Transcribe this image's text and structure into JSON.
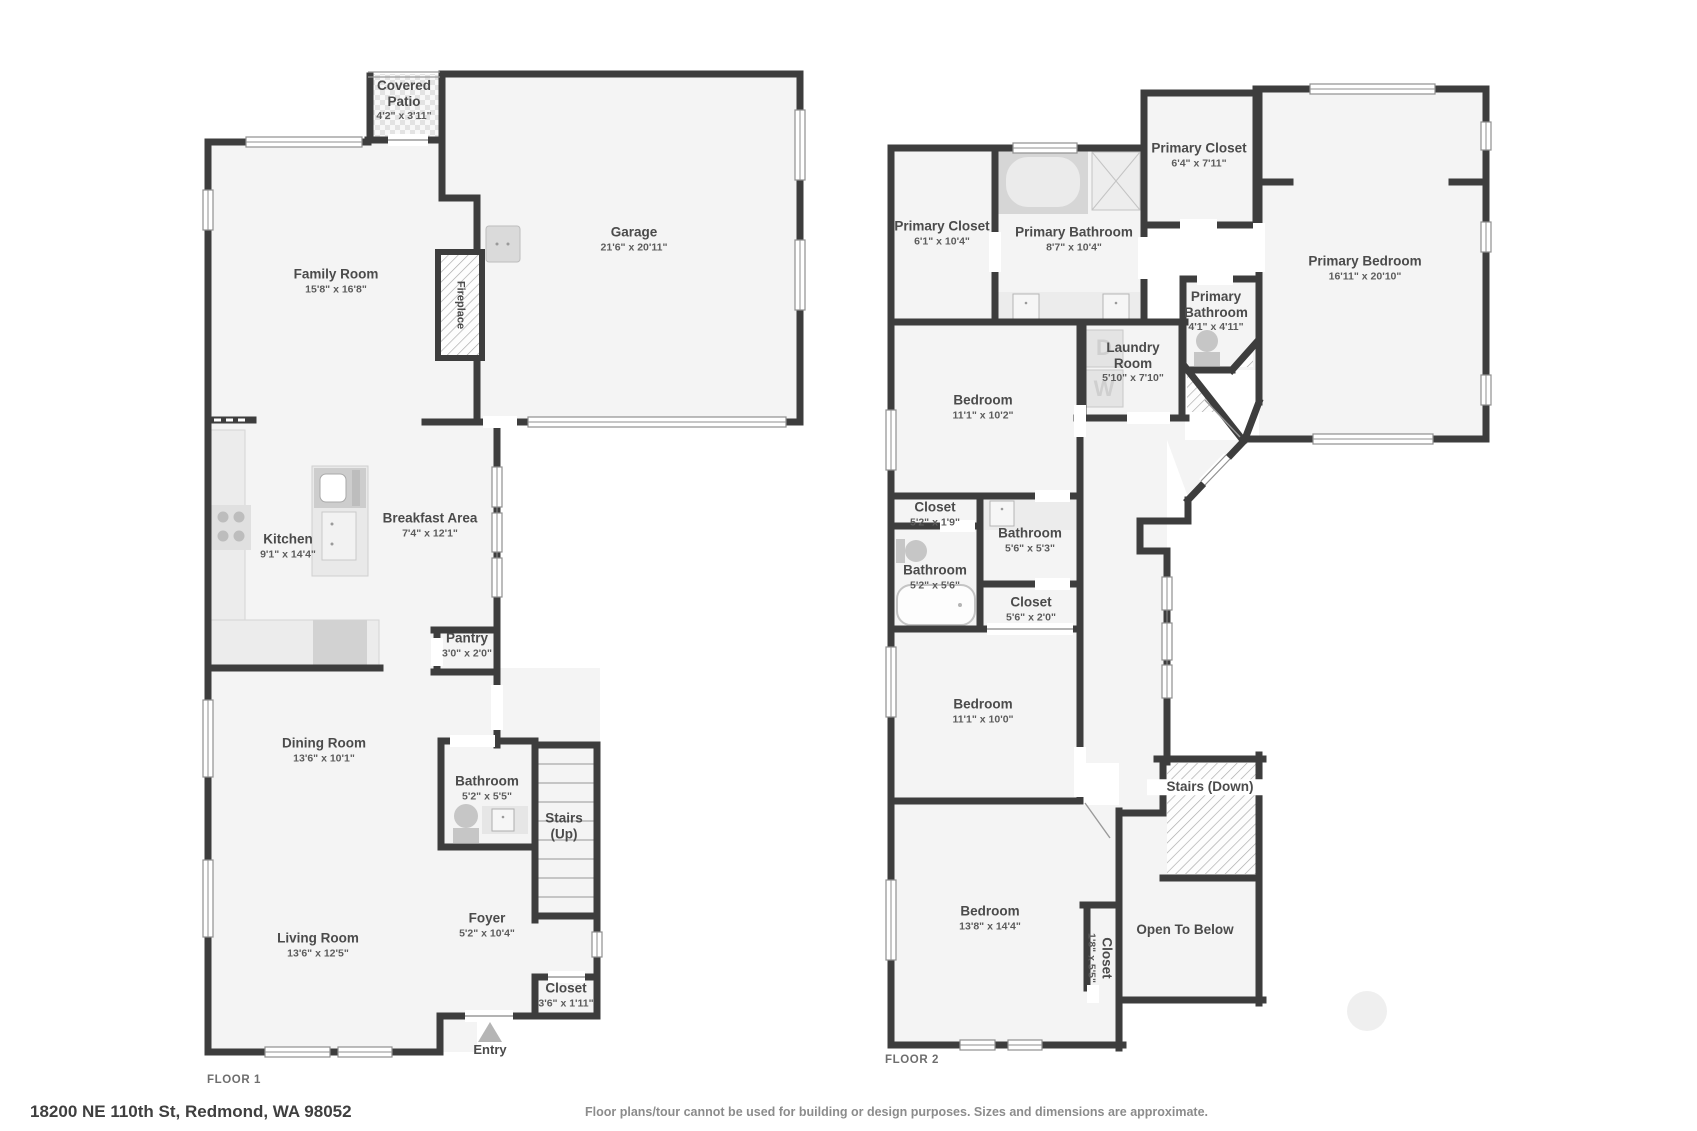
{
  "page": {
    "address": "18200 NE 110th St, Redmond, WA 98052",
    "disclaimer": "Floor plans/tour cannot be used for building or design purposes. Sizes and dimensions are approximate."
  },
  "entry": {
    "label": "Entry"
  },
  "colors": {
    "wall": "#3d3d3d",
    "room_fill": "#f4f4f4",
    "thin_line": "#8f8f8f",
    "fixture": "#cfcfcf",
    "accent_text": "#4b4b4b"
  },
  "floors": [
    {
      "caption": "FLOOR 1",
      "caption_x": 207,
      "caption_y": 1074,
      "rooms": [
        {
          "id": "covered-patio",
          "name": "Covered Patio",
          "dims": "4'2\" x 3'11\"",
          "x": 404,
          "y": 100,
          "w": 74
        },
        {
          "id": "family-room",
          "name": "Family Room",
          "dims": "15'8\" x 16'8\"",
          "x": 336,
          "y": 281,
          "w": 120
        },
        {
          "id": "garage",
          "name": "Garage",
          "dims": "21'6\" x 20'11\"",
          "x": 634,
          "y": 239,
          "w": 130
        },
        {
          "id": "fireplace",
          "name": "Fireplace",
          "dims": "",
          "x": 460,
          "y": 305,
          "w": 90,
          "rot": 90,
          "small": true
        },
        {
          "id": "kitchen",
          "name": "Kitchen",
          "dims": "9'1\" x 14'4\"",
          "x": 288,
          "y": 546,
          "w": 90
        },
        {
          "id": "breakfast-area",
          "name": "Breakfast Area",
          "dims": "7'4\" x 12'1\"",
          "x": 430,
          "y": 525,
          "w": 130
        },
        {
          "id": "pantry",
          "name": "Pantry",
          "dims": "3'0\" x 2'0\"",
          "x": 467,
          "y": 645,
          "w": 70
        },
        {
          "id": "dining-room",
          "name": "Dining Room",
          "dims": "13'6\" x 10'1\"",
          "x": 324,
          "y": 750,
          "w": 120
        },
        {
          "id": "bathroom-f1",
          "name": "Bathroom",
          "dims": "5'2\" x 5'5\"",
          "x": 487,
          "y": 788,
          "w": 100
        },
        {
          "id": "stairs-up",
          "name": "Stairs (Up)",
          "dims": "",
          "x": 564,
          "y": 826,
          "w": 54
        },
        {
          "id": "foyer",
          "name": "Foyer",
          "dims": "5'2\" x 10'4\"",
          "x": 487,
          "y": 925,
          "w": 110
        },
        {
          "id": "living-room",
          "name": "Living Room",
          "dims": "13'6\" x 12'5\"",
          "x": 318,
          "y": 945,
          "w": 120
        },
        {
          "id": "closet-f1",
          "name": "Closet",
          "dims": "3'6\" x 1'11\"",
          "x": 566,
          "y": 995,
          "w": 78
        }
      ]
    },
    {
      "caption": "FLOOR 2",
      "caption_x": 885,
      "caption_y": 1054,
      "rooms": [
        {
          "id": "primary-closet-left",
          "name": "Primary Closet",
          "dims": "6'1\" x 10'4\"",
          "x": 942,
          "y": 233,
          "w": 110
        },
        {
          "id": "primary-bathroom",
          "name": "Primary Bathroom",
          "dims": "8'7\" x 10'4\"",
          "x": 1074,
          "y": 239,
          "w": 150
        },
        {
          "id": "primary-closet-top",
          "name": "Primary Closet",
          "dims": "6'4\" x 7'11\"",
          "x": 1199,
          "y": 155,
          "w": 115
        },
        {
          "id": "primary-bedroom",
          "name": "Primary Bedroom",
          "dims": "16'11\" x 20'10\"",
          "x": 1365,
          "y": 268,
          "w": 170
        },
        {
          "id": "primary-bathroom-small",
          "name": "Primary Bathroom",
          "dims": "4'1\" x 4'11\"",
          "x": 1216,
          "y": 311,
          "w": 86
        },
        {
          "id": "laundry-room",
          "name": "Laundry Room",
          "dims": "5'10\" x 7'10\"",
          "x": 1133,
          "y": 362,
          "w": 76
        },
        {
          "id": "bedroom-upper",
          "name": "Bedroom",
          "dims": "11'1\" x 10'2\"",
          "x": 983,
          "y": 407,
          "w": 100
        },
        {
          "id": "closet-small",
          "name": "Closet",
          "dims": "5'2\" x 1'9\"",
          "x": 935,
          "y": 514,
          "w": 90
        },
        {
          "id": "bathroom-right",
          "name": "Bathroom",
          "dims": "5'6\" x 5'3\"",
          "x": 1030,
          "y": 540,
          "w": 100
        },
        {
          "id": "bathroom-left",
          "name": "Bathroom",
          "dims": "5'2\" x 5'6\"",
          "x": 935,
          "y": 577,
          "w": 100
        },
        {
          "id": "closet-mid",
          "name": "Closet",
          "dims": "5'6\" x 2'0\"",
          "x": 1031,
          "y": 609,
          "w": 90
        },
        {
          "id": "bedroom-mid",
          "name": "Bedroom",
          "dims": "11'1\" x 10'0\"",
          "x": 983,
          "y": 711,
          "w": 100
        },
        {
          "id": "stairs-down",
          "name": "Stairs (Down)",
          "dims": "",
          "x": 1210,
          "y": 787,
          "w": 120,
          "bg": true
        },
        {
          "id": "bedroom-bottom",
          "name": "Bedroom",
          "dims": "13'8\" x 14'4\"",
          "x": 990,
          "y": 918,
          "w": 110
        },
        {
          "id": "closet-vertical",
          "name": "Closet",
          "dims": "1'8\" x 5'5\"",
          "x": 1100,
          "y": 958,
          "w": 80,
          "rot": 90
        },
        {
          "id": "open-to-below",
          "name": "Open To Below",
          "dims": "",
          "x": 1185,
          "y": 930,
          "w": 140
        }
      ]
    }
  ]
}
